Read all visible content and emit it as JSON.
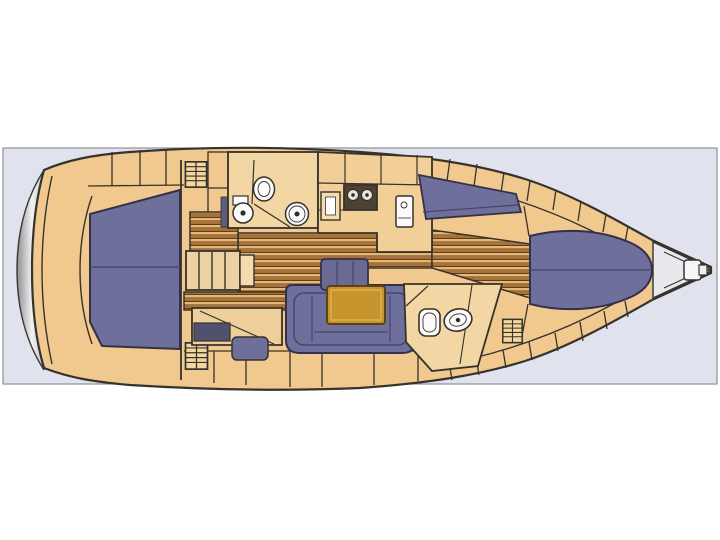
{
  "page": {
    "background": "#ffffff"
  },
  "panel": {
    "background": "#e0e3ee",
    "border": "#8f9097"
  },
  "colors": {
    "hull_deck": "#f1c88e",
    "cabin_floor": "#f2d6a4",
    "cabinet_light": "#f4d7a4",
    "outline": "#36322c",
    "upholstery": "#6f6f9c",
    "upholstery_seam": "#4c4870",
    "teak_light": "#e3b878",
    "teak_dark": "#a8713a",
    "teak_line": "#5f3f18",
    "table_top": "#c6952e",
    "stove_top": "#4f4132",
    "fixture_white": "#fbfbfb",
    "transom_light": "#f2f2f4",
    "transom_dark": "#8f8f93",
    "anchor_locker": "#e8e9ef",
    "nav_seat_dark": "#50506f"
  },
  "diagram": {
    "kind": "sailing-yacht-interior-floor-plan",
    "view": "overhead",
    "bow_direction": "right",
    "stern_direction": "left",
    "regions": [
      {
        "name": "swim-platform"
      },
      {
        "name": "aft-cabin-double-berth"
      },
      {
        "name": "companionway-steps"
      },
      {
        "name": "nav-station"
      },
      {
        "name": "forward-head"
      },
      {
        "name": "galley"
      },
      {
        "name": "salon-u-settee"
      },
      {
        "name": "salon-table"
      },
      {
        "name": "salon-bench"
      },
      {
        "name": "starboard-settee"
      },
      {
        "name": "aft-head"
      },
      {
        "name": "v-berth-cabin"
      },
      {
        "name": "anchor-locker"
      }
    ],
    "fixtures": [
      {
        "name": "toilet",
        "count": 2
      },
      {
        "name": "sink",
        "count": 3
      },
      {
        "name": "stove-two-burner",
        "count": 1
      },
      {
        "name": "locker-hatch",
        "count": 3
      },
      {
        "name": "anchor-windlass",
        "count": 1
      }
    ]
  }
}
